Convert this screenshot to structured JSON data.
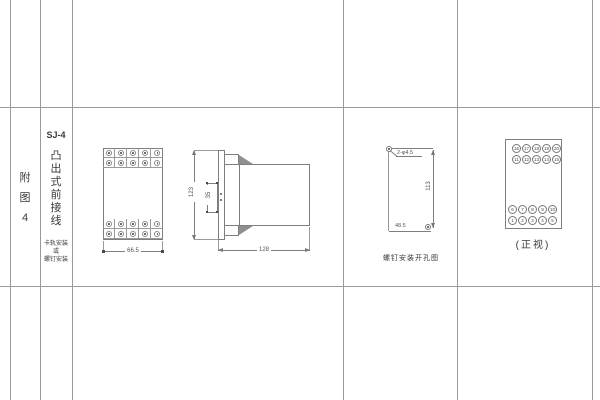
{
  "appendix": {
    "chars": [
      "附",
      "图",
      "4"
    ]
  },
  "title_block": {
    "model": "SJ-4",
    "title_chars": [
      "凸",
      "出",
      "式",
      "前",
      "接",
      "线"
    ],
    "note_lines": [
      "卡轨安装",
      "或",
      "螺钉安装"
    ]
  },
  "front_view": {
    "width_dim": "66.5"
  },
  "side_view": {
    "height_dim": "123",
    "clip_dim": "35",
    "depth_dim": "128"
  },
  "drill_view": {
    "hole_label": "2-φ4.5",
    "height_dim": "113",
    "width_dim": "48.5",
    "caption": "螺钉安装开孔图"
  },
  "terminal_view": {
    "caption": "(正视)",
    "rows": [
      [
        "16",
        "17",
        "18",
        "19",
        "20"
      ],
      [
        "11",
        "12",
        "13",
        "14",
        "15"
      ],
      [
        "6",
        "7",
        "8",
        "9",
        "10"
      ],
      [
        "1",
        "2",
        "3",
        "4",
        "5"
      ]
    ]
  },
  "colors": {
    "grid_line": "#999999",
    "drawing_line": "#7e7e7e",
    "text": "#3a3a3a"
  }
}
